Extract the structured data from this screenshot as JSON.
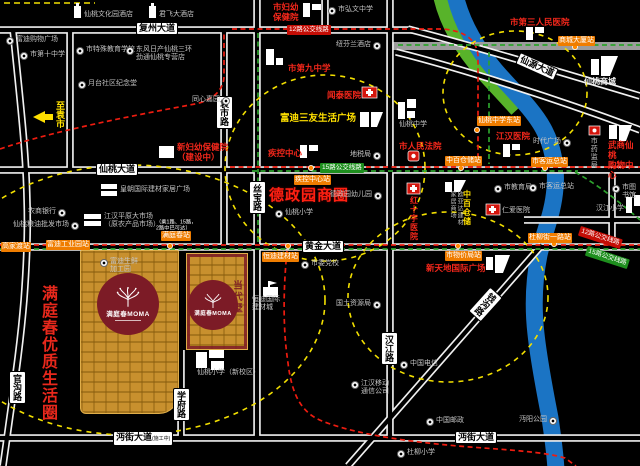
{
  "colors": {
    "gold": "#c8902e",
    "logo_red": "#7c1b26",
    "accent_red": "#ff2012",
    "accent_yellow": "#ffe000",
    "stop_orange": "#ef7d00",
    "bus12_red": "#ed1c10",
    "bus15_green": "#2da32d",
    "river_blue": "#1b74c4",
    "bank_green": "#58b32a"
  },
  "project": {
    "name": "满庭春MOMA",
    "tagline": "当代墅"
  },
  "zones": {
    "dezheng": {
      "text": "德政园商圈"
    },
    "mantingchun": {
      "text": "满庭春优质生活圈"
    }
  },
  "direction": {
    "text": "至袁市"
  },
  "note": {
    "line1": "（乘1路、15路，",
    "line2": "2路中巴可达）"
  },
  "roads": {
    "labels": [
      {
        "t": "复州大道",
        "x": 136,
        "y": 22,
        "o": "h"
      },
      {
        "t": "仙桃大道",
        "x": 96,
        "y": 163,
        "o": "h"
      },
      {
        "t": "黄金大道",
        "x": 302,
        "y": 240,
        "o": "h"
      },
      {
        "t": "沔街大道",
        "x": 113,
        "y": 431,
        "o": "h",
        "suffix": "(施工中)"
      },
      {
        "t": "沔街大道",
        "x": 455,
        "y": 431,
        "o": "h"
      },
      {
        "t": "袁市路",
        "x": 216,
        "y": 96,
        "o": "v"
      },
      {
        "t": "丝宝路",
        "x": 249,
        "y": 181,
        "o": "v"
      },
      {
        "t": "学府路",
        "x": 173,
        "y": 388,
        "o": "v"
      },
      {
        "t": "汉江路",
        "x": 381,
        "y": 332,
        "o": "v"
      },
      {
        "t": "官沟路",
        "x": 9,
        "y": 371,
        "o": "v"
      },
      {
        "t": "钱沟路",
        "x": 477,
        "y": 288,
        "o": "rv",
        "rot": 42
      },
      {
        "t": "仙源大道",
        "x": 516,
        "y": 60,
        "o": "r",
        "rot": 24
      }
    ]
  },
  "bus_stops": [
    {
      "t": "商城大厦站",
      "x": 558,
      "y": 36
    },
    {
      "t": "仙桃中学东站",
      "x": 477,
      "y": 116
    },
    {
      "t": "中百仓储站",
      "x": 445,
      "y": 156
    },
    {
      "t": "市客运总站",
      "x": 531,
      "y": 157
    },
    {
      "t": "疾控中心站",
      "x": 294,
      "y": 175
    },
    {
      "t": "恒迪建材站",
      "x": 262,
      "y": 252
    },
    {
      "t": "满庭春站",
      "x": 161,
      "y": 231
    },
    {
      "t": "富迪工业园站",
      "x": 46,
      "y": 240
    },
    {
      "t": "高家渡站",
      "x": 1,
      "y": 242
    },
    {
      "t": "市物价局站",
      "x": 445,
      "y": 251
    },
    {
      "t": "杜柳街一路站",
      "x": 528,
      "y": 233
    }
  ],
  "bus_lines": [
    {
      "t": "12路公交线路",
      "c": "red",
      "x": 287,
      "y": 25
    },
    {
      "t": "15路公交线路",
      "c": "green",
      "x": 320,
      "y": 163
    },
    {
      "t": "12路公交线路",
      "c": "red",
      "x": 581,
      "y": 226,
      "rot": 18
    },
    {
      "t": "15路公交线路",
      "c": "green",
      "x": 588,
      "y": 246,
      "rot": 18
    }
  ],
  "pois": [
    {
      "t": "仙桃文化园酒店",
      "x": 84,
      "y": 11,
      "c": "g"
    },
    {
      "t": "君飞大酒店",
      "x": 159,
      "y": 11,
      "c": "g"
    },
    {
      "t": "富迪购物广场",
      "x": 6,
      "y": 36,
      "c": "g",
      "icon": 1
    },
    {
      "t": "市第十中学",
      "x": 20,
      "y": 51,
      "c": "g",
      "icon": 1
    },
    {
      "t": "市特殊教育学校",
      "x": 76,
      "y": 46,
      "c": "g",
      "icon": 1
    },
    {
      "t": "东风日产仙桃三环|劲通仙桃专营店",
      "x": 126,
      "y": 46,
      "c": "g",
      "icon": 1
    },
    {
      "t": "月台社区纪念堂",
      "x": 78,
      "y": 80,
      "c": "g",
      "icon": 1
    },
    {
      "t": "同心嘉园",
      "x": 192,
      "y": 96,
      "c": "g",
      "icon": 1,
      "ir": 1
    },
    {
      "t": "市弘文中学",
      "x": 328,
      "y": 6,
      "c": "g",
      "icon": 1
    },
    {
      "t": "纽芬兰酒店",
      "x": 336,
      "y": 41,
      "c": "g",
      "icon": 1,
      "ir": 1
    },
    {
      "t": "市妇幼|保健院",
      "x": 273,
      "y": 2,
      "c": "r"
    },
    {
      "t": "市第九中学",
      "x": 288,
      "y": 63,
      "c": "r"
    },
    {
      "t": "闻泰医院",
      "x": 327,
      "y": 90,
      "c": "r"
    },
    {
      "t": "市第三人民医院",
      "x": 510,
      "y": 17,
      "c": "r"
    },
    {
      "t": "仙桃商城",
      "x": 584,
      "y": 77,
      "c": "w"
    },
    {
      "t": "富迪三友生活广场",
      "x": 280,
      "y": 113,
      "c": "y",
      "fs": 9.5
    },
    {
      "t": "仙桃中学",
      "x": 399,
      "y": 121,
      "c": "g"
    },
    {
      "t": "新妇幼保健院|（建设中）",
      "x": 177,
      "y": 142,
      "c": "r"
    },
    {
      "t": "疾控中心",
      "x": 268,
      "y": 148,
      "c": "r"
    },
    {
      "t": "江汉医院",
      "x": 496,
      "y": 131,
      "c": "r"
    },
    {
      "t": "时代广场",
      "x": 533,
      "y": 138,
      "c": "g",
      "icon": 1,
      "ir": 1
    },
    {
      "t": "市药监局",
      "x": 589,
      "y": 137,
      "c": "g",
      "vert": 1
    },
    {
      "t": "武商仙桃|购物中心",
      "x": 608,
      "y": 140,
      "c": "r"
    },
    {
      "t": "地税局",
      "x": 350,
      "y": 151,
      "c": "g",
      "icon": 1,
      "ir": 1
    },
    {
      "t": "市人民法院",
      "x": 399,
      "y": 141,
      "c": "r"
    },
    {
      "t": "德政园幼儿园",
      "x": 330,
      "y": 191,
      "c": "g",
      "icon": 1,
      "ir": 1
    },
    {
      "t": "仙桃小学",
      "x": 275,
      "y": 209,
      "c": "g",
      "icon": 1
    },
    {
      "t": "红十字医院",
      "x": 409,
      "y": 196,
      "c": "r",
      "vert": 1,
      "fs": 8
    },
    {
      "t": "家居商场",
      "x": 448,
      "y": 191,
      "c": "g",
      "vert": 1,
      "fs": 6
    },
    {
      "t": "欧亚达建材",
      "x": 455,
      "y": 191,
      "c": "g",
      "vert": 1,
      "fs": 6
    },
    {
      "t": "中百仓储",
      "x": 462,
      "y": 190,
      "c": "y",
      "vert": 1,
      "fs": 8
    },
    {
      "t": "市教育局",
      "x": 494,
      "y": 184,
      "c": "g",
      "icon": 1
    },
    {
      "t": "市客运总站",
      "x": 529,
      "y": 183,
      "c": "g",
      "icon": 1
    },
    {
      "t": "仁爱医院",
      "x": 502,
      "y": 207,
      "c": "g"
    },
    {
      "t": "汉江小学",
      "x": 596,
      "y": 205,
      "c": "g"
    },
    {
      "t": "市图书馆",
      "x": 612,
      "y": 184,
      "c": "g",
      "icon": 1
    },
    {
      "t": "农商银行",
      "x": 28,
      "y": 208,
      "c": "g",
      "icon": 1,
      "ir": 1
    },
    {
      "t": "江汉平原大市场|（原农产品市场）",
      "x": 104,
      "y": 213,
      "c": "g"
    },
    {
      "t": "仙桃粮油批发市场",
      "x": 13,
      "y": 221,
      "c": "g",
      "icon": 1,
      "ir": 1
    },
    {
      "t": "皇朝国际建材家居广场",
      "x": 120,
      "y": 186,
      "c": "g"
    },
    {
      "t": "富迪生鲜|加工园",
      "x": 100,
      "y": 258,
      "c": "g",
      "icon": 1
    },
    {
      "t": "市委党校",
      "x": 301,
      "y": 260,
      "c": "g",
      "icon": 1
    },
    {
      "t": "恒迪国际|建材城",
      "x": 252,
      "y": 296,
      "c": "g"
    },
    {
      "t": "国土资源局",
      "x": 336,
      "y": 300,
      "c": "g",
      "icon": 1,
      "ir": 1
    },
    {
      "t": "新天地国际广场",
      "x": 426,
      "y": 263,
      "c": "r"
    },
    {
      "t": "中国电信",
      "x": 400,
      "y": 360,
      "c": "g",
      "icon": 1
    },
    {
      "t": "江汉移动|通信公司",
      "x": 351,
      "y": 380,
      "c": "g",
      "icon": 1
    },
    {
      "t": "仙桃小学（新校区）",
      "x": 197,
      "y": 369,
      "c": "g"
    },
    {
      "t": "中国邮政",
      "x": 426,
      "y": 417,
      "c": "g",
      "icon": 1
    },
    {
      "t": "沔阳公园",
      "x": 519,
      "y": 416,
      "c": "g",
      "icon": 1,
      "ir": 1
    },
    {
      "t": "杜柳小学",
      "x": 397,
      "y": 449,
      "c": "g",
      "icon": 1
    }
  ]
}
